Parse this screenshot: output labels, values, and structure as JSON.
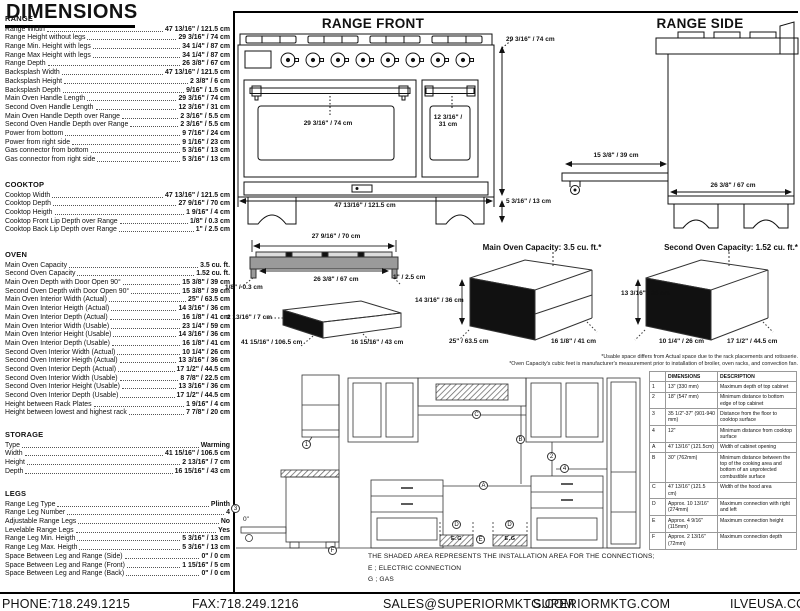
{
  "page_title": "DIMENSIONS",
  "sections": [
    {
      "id": "range",
      "title": "RANGE",
      "rows": [
        [
          "Range Width",
          "47 13/16\" / 121.5 cm"
        ],
        [
          "Range Height without legs",
          "29 3/16\" / 74 cm"
        ],
        [
          "Range Min. Height with legs",
          "34 1/4\" / 87 cm"
        ],
        [
          "Range Max Height with legs",
          "34 1/4\" / 87 cm"
        ],
        [
          "Range Depth",
          "26 3/8\" / 67 cm"
        ],
        [
          "Backsplash Width",
          "47 13/16\" / 121.5 cm"
        ],
        [
          "Backsplash Height",
          "2 3/8\" / 6 cm"
        ],
        [
          "Backsplash Depth",
          "9/16\" / 1.5 cm"
        ],
        [
          "Main Oven Handle Length",
          "29 3/16\" / 74 cm"
        ],
        [
          "Second Oven Handle Length",
          "12 3/16\" / 31 cm"
        ],
        [
          "Main Oven Handle Depth over Range",
          "2 3/16\" / 5.5 cm"
        ],
        [
          "Second Oven Handle Depth over Range",
          "2 3/16\" / 5.5 cm"
        ],
        [
          "Power from bottom",
          "9 7/16\" / 24 cm"
        ],
        [
          "Power from right side",
          "9 1/16\" / 23 cm"
        ],
        [
          "Gas connector from bottom",
          "5 3/16\" / 13 cm"
        ],
        [
          "Gas connector from right side",
          "5 3/16\" / 13 cm"
        ]
      ]
    },
    {
      "id": "cooktop",
      "title": "COOKTOP",
      "rows": [
        [
          "Cooktop Width",
          "47 13/16\" / 121.5 cm"
        ],
        [
          "Cooktop Depth",
          "27 9/16\" / 70 cm"
        ],
        [
          "Cooktop Heigth",
          "1 9/16\" / 4 cm"
        ],
        [
          "Cooktop Front Lip Depth over Range",
          "1/8\" / 0.3 cm"
        ],
        [
          "Cooktop Back Lip Depth over Range",
          "1\" / 2.5 cm"
        ]
      ]
    },
    {
      "id": "oven",
      "title": "OVEN",
      "rows": [
        [
          "Main Oven Capacity",
          "3.5 cu. ft."
        ],
        [
          "Second Oven Capacity",
          "1.52 cu. ft."
        ],
        [
          "Main Oven Depth with Door Open 90°",
          "15 3/8\" / 39 cm"
        ],
        [
          "Second Oven Depth with Door Open 90°",
          "15 3/8\" / 39 cm"
        ],
        [
          "Main Oven Interior Width (Actual)",
          "25\" / 63.5 cm"
        ],
        [
          "Main Oven Interior Heigth (Actual)",
          "14 3/16\" / 36 cm"
        ],
        [
          "Main Oven Interior Depth (Actual)",
          "16 1/8\" / 41 cm"
        ],
        [
          "Main Oven Interior Width (Usable)",
          "23 1/4\" / 59 cm"
        ],
        [
          "Main Oven Interior Height (Usable)",
          "14 3/16\" / 36 cm"
        ],
        [
          "Main Oven Interior Depth (Usable)",
          "16 1/8\" / 41 cm"
        ],
        [
          "Second Oven Interior Width (Actual)",
          "10 1/4\" / 26 cm"
        ],
        [
          "Second Oven Interior Heigth (Actual)",
          "13 3/16\" / 36 cm"
        ],
        [
          "Second Oven Interior Depth (Actual)",
          "17 1/2\" / 44.5 cm"
        ],
        [
          "Second Oven Interior Width (Usable)",
          "8 7/8\" / 22.5 cm"
        ],
        [
          "Second Oven Interior Height (Usable)",
          "13 3/16\" / 36 cm"
        ],
        [
          "Second Oven Interior Depth (Usable)",
          "17 1/2\" / 44.5 cm"
        ],
        [
          "Height between Rack Plates",
          "1 9/16\" / 4 cm"
        ],
        [
          "Height between lowest and highest rack",
          "7 7/8\" / 20 cm"
        ]
      ]
    },
    {
      "id": "storage",
      "title": "STORAGE",
      "rows": [
        [
          "Type",
          "Warming"
        ],
        [
          "Width",
          "41 15/16\" / 106.5 cm"
        ],
        [
          "Height",
          "2 13/16\" / 7 cm"
        ],
        [
          "Depth",
          "16 15/16\" / 43 cm"
        ]
      ]
    },
    {
      "id": "legs",
      "title": "LEGS",
      "rows": [
        [
          "Range Leg Type",
          "Plinth"
        ],
        [
          "Range Leg Number",
          "4"
        ],
        [
          "Adjustable Range Legs",
          "No"
        ],
        [
          "Levelable Range Legs",
          "Yes"
        ],
        [
          "Range Leg Min. Heigth",
          "5 3/16\" / 13 cm"
        ],
        [
          "Range Leg Max. Heigth",
          "5 3/16\" / 13 cm"
        ],
        [
          "Space Between Leg and Range (Side)",
          "0\" / 0 cm"
        ],
        [
          "Space Between Leg and Range (Front)",
          "1 15/16\" / 5 cm"
        ],
        [
          "Space Between Leg and Range (Back)",
          "0\" / 0 cm"
        ]
      ]
    }
  ],
  "front": {
    "title": "RANGE FRONT",
    "width": "47 13/16\" / 121.5 cm",
    "height": "29 3/16\" / 74 cm",
    "leg_height": "5 3/16\" / 13 cm",
    "main_handle": "29 3/16\" / 74 cm",
    "second_handle_line1": "12 3/16\" /",
    "second_handle_line2": "31 cm"
  },
  "side": {
    "title": "RANGE SIDE",
    "door_open_depth": "15 3/8\" / 39 cm",
    "depth": "26 3/8\" / 67 cm"
  },
  "cooktop_profile": {
    "depth": "27 9/16\" / 70 cm",
    "inner_depth": "26 3/8\" / 67 cm",
    "back_lip": "1\" / 2.5 cm",
    "front_lip": "1/8\" / 0.3 cm"
  },
  "storage_drawing": {
    "height": "2 13/16\" / 7 cm",
    "width": "41 15/16\" / 106.5 cm",
    "depth": "16 15/16\" / 43 cm"
  },
  "capacity_main": {
    "title": "Main Oven Capacity: 3.5 cu. ft.*",
    "height": "14 3/16\" / 36 cm",
    "width": "25\" / 63.5 cm",
    "depth": "16 1/8\" / 41 cm"
  },
  "capacity_second": {
    "title": "Second Oven Capacity: 1.52 cu. ft.*",
    "height": "13 3/16\" / 36 cm",
    "width": "10 1/4\" / 26 cm",
    "depth": "17 1/2\" / 44.5 cm"
  },
  "footnotes": [
    "*Usable space differs from Actual space due to the rack placements and rotisserie.",
    "*Oven Capacity's cubic feet is manufacturer's measurement prior to installation of broiler, oven racks, and convection fan."
  ],
  "installation": {
    "note": "THE SHADED AREA REPRESENTS THE INSTALLATION AREA FOR THE CONNECTIONS;",
    "legend": [
      "E ; ELECTRIC CONNECTION",
      "G ; GAS"
    ],
    "markers": {
      "m1": "1",
      "m2": "2",
      "m3": "3",
      "m4": "4",
      "mA": "A",
      "mB": "B",
      "mC": "C",
      "mD": "D",
      "mE": "E",
      "mF": "F"
    },
    "shaded_label": "E.G",
    "zero_label": "0\""
  },
  "dim_table": {
    "headers": [
      "",
      "DIMENSIONS",
      "DESCRIPTION"
    ],
    "rows": [
      [
        "1",
        "13\" (330 mm)",
        "Maximum depth of top cabinet"
      ],
      [
        "2",
        "18\" (547 mm)",
        "Minimum distance to bottom edge of top cabinet"
      ],
      [
        "3",
        "35 1/2\"-37\" (901-940 mm)",
        "Distance from the floor to cooktop surface"
      ],
      [
        "4",
        "12\"",
        "Minimum distance from cooktop surface"
      ],
      [
        "A",
        "47 13/16\" (121.5cm)",
        "Width of cabinet opening"
      ],
      [
        "B",
        "30\" (762mm)",
        "Minimum distance between the top of the cooking area and bottom of an unprotected combustible surface"
      ],
      [
        "C",
        "47 13/16\" (121.5 cm)",
        "Width of the hood area"
      ],
      [
        "D",
        "Approx. 10 13/16\" (274mm)",
        "Maximum connection with right and left"
      ],
      [
        "E",
        "Approx. 4 9/16\" (115mm)",
        "Maximum connection height"
      ],
      [
        "F",
        "Approx. 2 13/16\" (72mm)",
        "Maximum connection depth"
      ]
    ]
  },
  "footer": {
    "items": [
      "PHONE:718.249.1215",
      "FAX:718.249.1216",
      "SALES@SUPERIORMKTG.COM",
      "SUPERIORMKTG.COM",
      "ILVEUSA.COM"
    ]
  }
}
